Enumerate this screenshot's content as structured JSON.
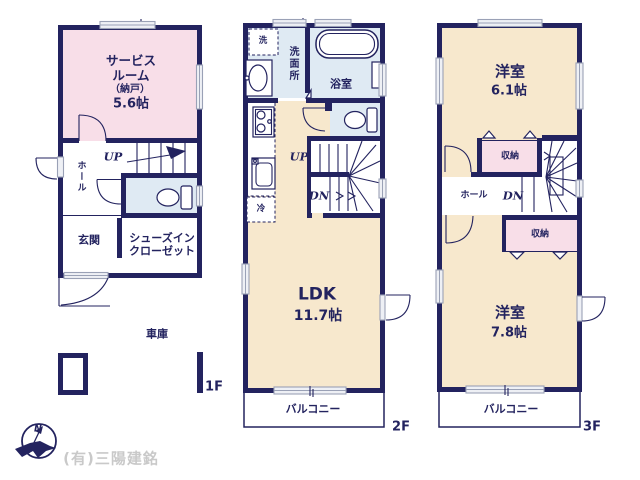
{
  "colors": {
    "wall": "#23235f",
    "pink": "#f8dee8",
    "cream": "#f7e8cd",
    "blue": "#dfeaf3",
    "winstroke": "#9aa1b6",
    "winfill": "#eef0f5",
    "watermark": "#c9c9c9"
  },
  "f1": {
    "floor_label": "1F",
    "service_l1": "サービス",
    "service_l2": "ルーム",
    "service_l3": "（納戸）",
    "service_size": "5.6帖",
    "up": "UP",
    "hall": "ホール",
    "genkan": "玄関",
    "sic_l1": "シューズイン",
    "sic_l2": "クローゼット",
    "garage": "車庫"
  },
  "f2": {
    "floor_label": "2F",
    "washer": "洗",
    "washroom": "洗面所",
    "bath": "浴室",
    "up": "UP",
    "dn": "DN",
    "fridge": "冷",
    "ldk": "LDK",
    "ldk_size": "11.7帖",
    "balcony": "バルコニー"
  },
  "f3": {
    "floor_label": "3F",
    "bed1": "洋室",
    "bed1_size": "6.1帖",
    "closet1": "収納",
    "hall": "ホール",
    "dn": "DN",
    "closet2": "収納",
    "bed2": "洋室",
    "bed2_size": "7.8帖",
    "balcony": "バルコニー"
  },
  "footer": {
    "company": "(有)三陽建銘",
    "north": "N"
  }
}
